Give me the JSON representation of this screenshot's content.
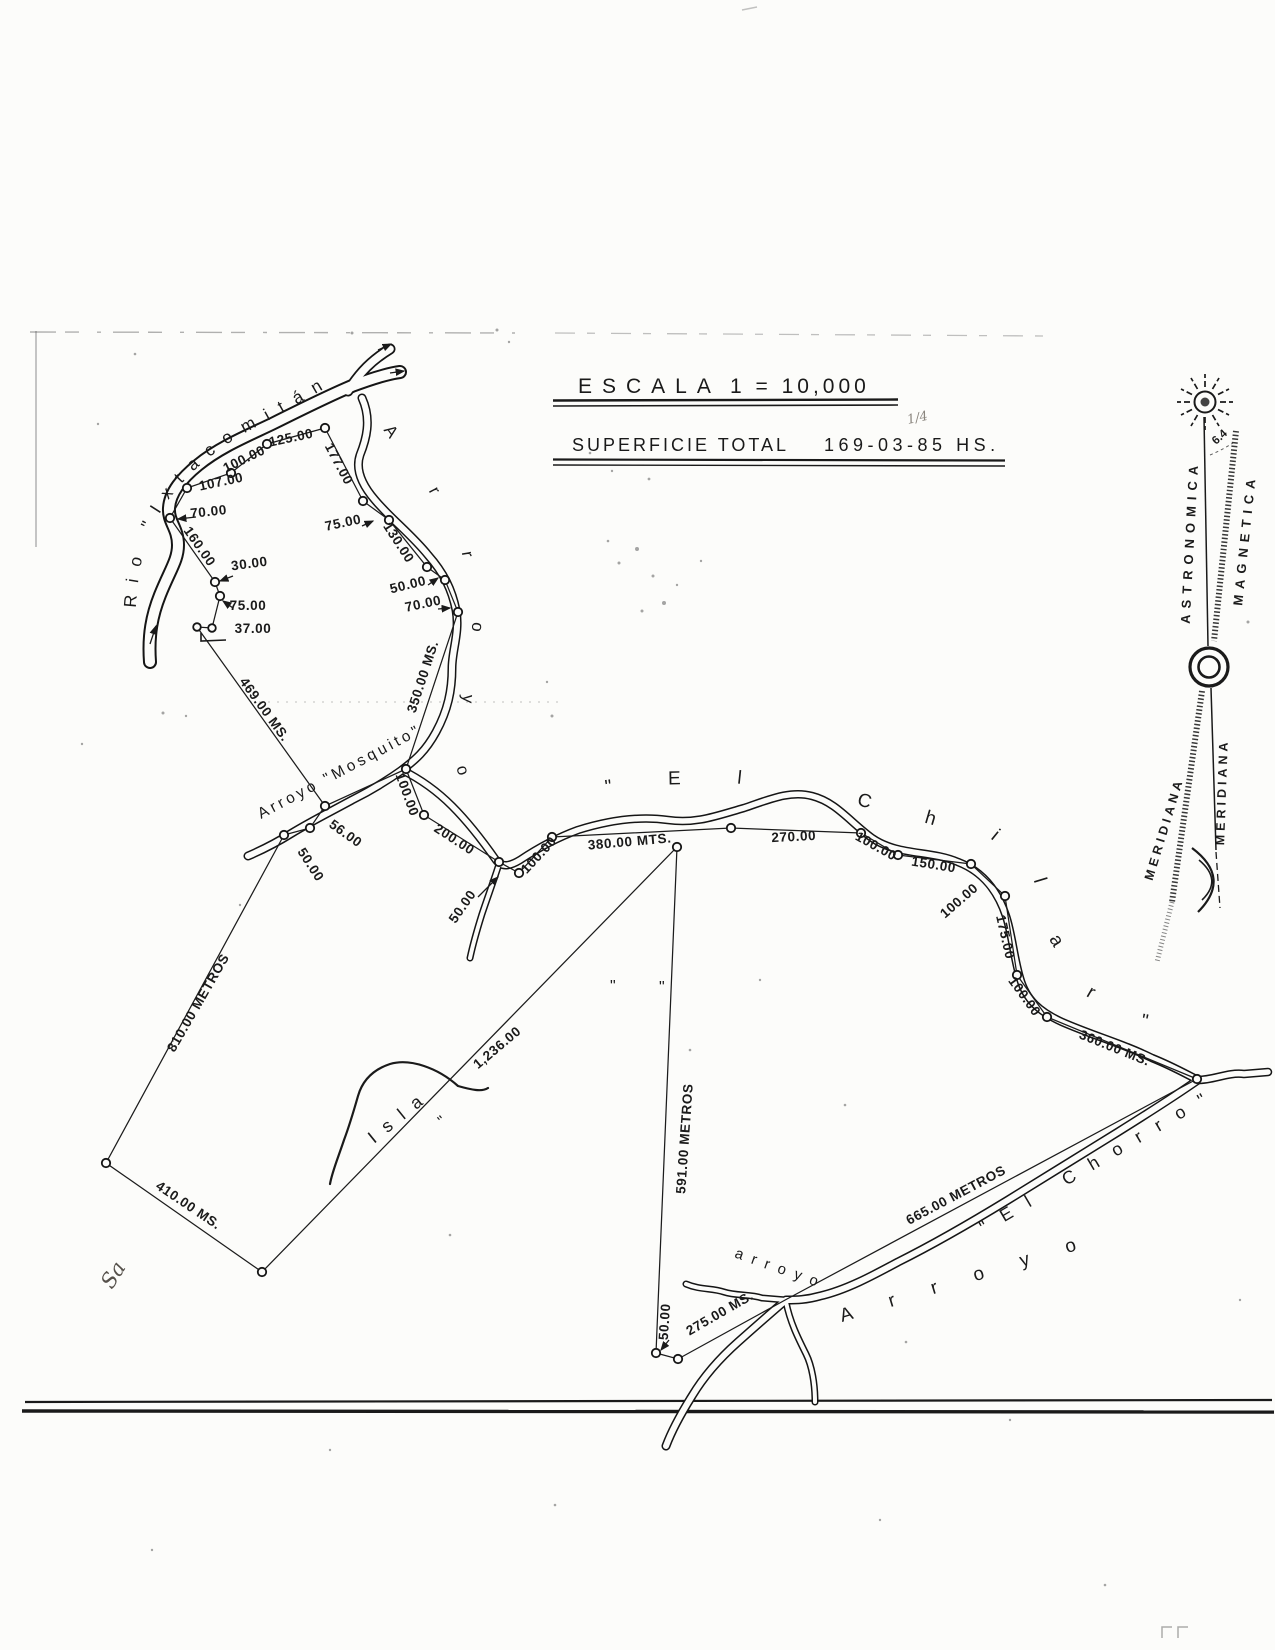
{
  "title_block": {
    "escala_label": "ESCALA",
    "escala_value": "1 = 10,000",
    "superficie_label": "SUPERFICIE  TOTAL",
    "superficie_value": "169-03-85 HS.",
    "pencil_note": "1/4"
  },
  "compass": {
    "declination": "6.4",
    "line_astronomica": "ASTRONOMICA",
    "line_magnetica": "MAGNETICA",
    "meridiana_left": "MERIDIANA",
    "meridiana_right": "MERIDIANA"
  },
  "features": {
    "rio_ixtacomitan": "Rio \"Ixtacomitán",
    "arroyo_norte": "Arroyo",
    "arroyo_mosquito": "Arroyo \"Mosquito\"",
    "el_chilar": "\"El Chilar\"",
    "arroyo_chorro": "Arroyo",
    "el_chorro": "\"El Chorro\"",
    "arroyo_small": "arroyo",
    "isla_label": "Isla",
    "handwritten_note": "Sa",
    "quote_mark": "\""
  },
  "dims": {
    "d107": "107.00",
    "d100a": "100.00",
    "d125": "125.00",
    "d177": "177.00",
    "d70a": "70.00",
    "d160": "160.00",
    "d30": "30.00",
    "d75a": "75.00",
    "d37": "37.00",
    "d75b": "75.00",
    "d130": "130.00",
    "d50a": "50.00",
    "d70b": "70.00",
    "d350": "350.00 MS.",
    "d100b": "100.00",
    "d200": "200.00",
    "d50b": "50.00",
    "d56": "56.00",
    "d50c": "50.00",
    "d100c": "100.00",
    "d380": "380.00 MTS.",
    "d270": "270.00",
    "d100d": "100.00",
    "d150": "150.00",
    "d100e": "100.00",
    "d175": "175.00",
    "d100f": "100.00",
    "d360": "360.00 MS.",
    "d469": "469.00 MS.",
    "d810": "810.00 METROS",
    "d410": "410.00 MS.",
    "d1236": "1,236.00",
    "d591": "591.00 METROS",
    "d275": "275.00 MS.",
    "d50d": "50.00",
    "d665": "665.00 METROS"
  }
}
